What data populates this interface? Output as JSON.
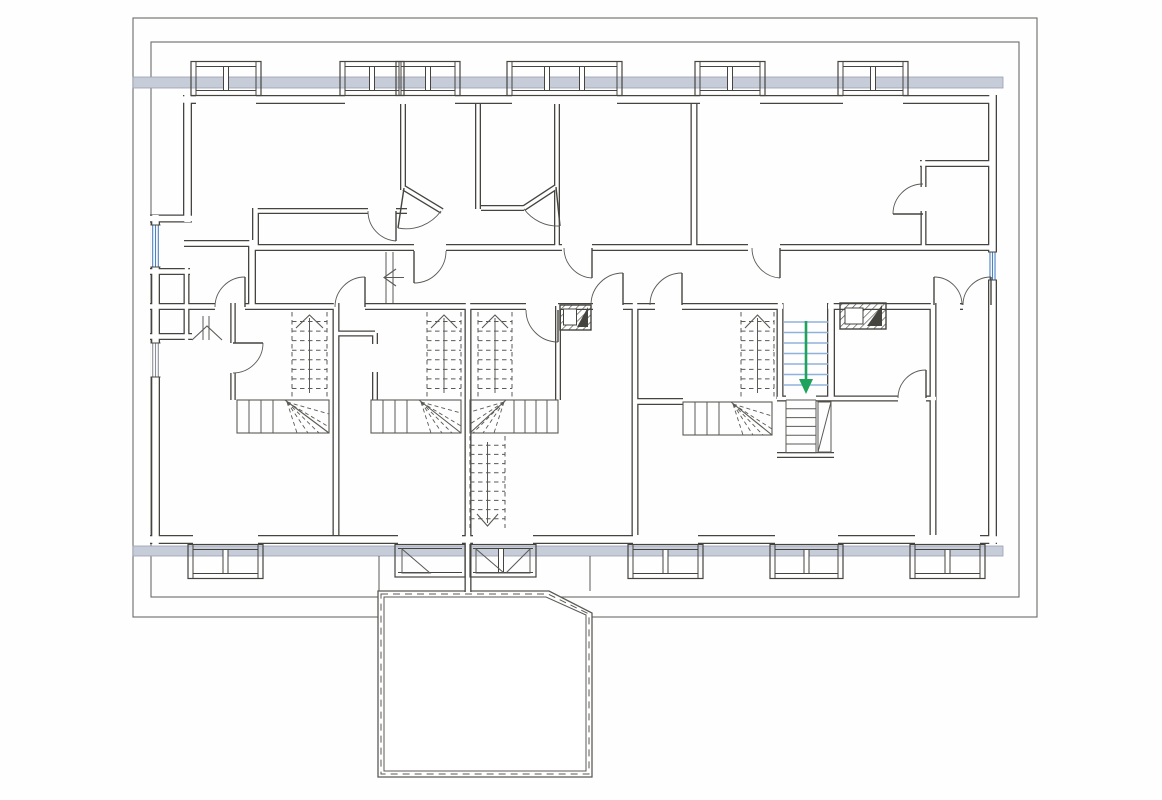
{
  "plan": {
    "canvas": {
      "w": 1162,
      "h": 800,
      "bg": "#fefefe"
    },
    "colors": {
      "ink": "#45443f",
      "thin": "#5b5a55",
      "eave": "#6b6b68",
      "white": "#ffffff",
      "band_fill": "#c6ccd8",
      "band_edge": "#99a1b3",
      "window_blue": "#4b80c2",
      "window_gray": "#8a8f99",
      "stair_blue": "#8fb2da",
      "arrow_green": "#1ea35c",
      "hatch": "#4a4a46"
    },
    "eaves": [
      {
        "x": 133,
        "y": 18,
        "w": 904,
        "h": 599
      },
      {
        "x": 151,
        "y": 42,
        "w": 868,
        "h": 555
      }
    ],
    "sill_bands": [
      {
        "x": 133,
        "y": 77,
        "w": 870,
        "h": 11
      },
      {
        "x": 133,
        "y": 546,
        "w": 870,
        "h": 10
      }
    ],
    "walls": [
      {
        "t": 9,
        "segs": [
          [
            183,
            99.5,
            196,
            99.5
          ],
          [
            256,
            99.5,
            345,
            99.5
          ],
          [
            455,
            99.5,
            512,
            99.5
          ],
          [
            617,
            99.5,
            700,
            99.5
          ],
          [
            760,
            99.5,
            843,
            99.5
          ],
          [
            903,
            99.5,
            992,
            99.5
          ],
          [
            150,
            539.5,
            193,
            539.5
          ],
          [
            258,
            539.5,
            398,
            539.5
          ],
          [
            462,
            539.5,
            473,
            539.5
          ],
          [
            533,
            539.5,
            633,
            539.5
          ],
          [
            698,
            539.5,
            775,
            539.5
          ],
          [
            838,
            539.5,
            915,
            539.5
          ],
          [
            980,
            539.5,
            997,
            539.5
          ],
          [
            187.5,
            95,
            187.5,
            222
          ],
          [
            155.5,
            215,
            155.5,
            544
          ],
          [
            992.5,
            95,
            992.5,
            544
          ]
        ]
      },
      {
        "t": 8,
        "segs": [
          [
            252,
            240,
            252,
            307
          ],
          [
            150,
            218.5,
            192,
            218.5
          ],
          [
            831,
            303,
            831,
            399
          ]
        ]
      },
      {
        "t": 7,
        "segs": [
          [
            252,
            247.5,
            414,
            247.5
          ],
          [
            446,
            247.5,
            562,
            247.5
          ],
          [
            592,
            247.5,
            748,
            247.5
          ],
          [
            780,
            247.5,
            992,
            247.5
          ],
          [
            184,
            243.5,
            256,
            243.5
          ],
          [
            255.5,
            208,
            255.5,
            247
          ],
          [
            150,
            306.5,
            215,
            306.5
          ],
          [
            245,
            306.5,
            335,
            306.5
          ],
          [
            365,
            306.5,
            526,
            306.5
          ],
          [
            558,
            306.5,
            593,
            306.5
          ],
          [
            623,
            306.5,
            655,
            306.5
          ],
          [
            682,
            306.5,
            783,
            306.5
          ],
          [
            828,
            306.5,
            934,
            306.5
          ],
          [
            960,
            306.5,
            963,
            306.5
          ],
          [
            150,
            271.5,
            190,
            271.5
          ],
          [
            150,
            336.5,
            192,
            336.5
          ],
          [
            694,
            104,
            694,
            247
          ],
          [
            920,
            163.5,
            992,
            163.5
          ],
          [
            336,
            303,
            336,
            535
          ],
          [
            468,
            303,
            468,
            592
          ],
          [
            635,
            303,
            635,
            535
          ],
          [
            633,
            401.5,
            683,
            401.5
          ],
          [
            780,
            303,
            780,
            399
          ],
          [
            933,
            303,
            933,
            535
          ]
        ]
      },
      {
        "t": 6,
        "segs": [
          [
            186.5,
            268,
            186.5,
            340
          ],
          [
            403,
            104,
            403,
            190
          ],
          [
            478,
            104,
            478,
            209
          ],
          [
            481,
            208,
            524,
            208
          ],
          [
            557,
            104,
            557,
            247
          ],
          [
            404,
            188,
            442,
            211
          ],
          [
            524,
            208,
            556,
            187
          ],
          [
            923.5,
            160,
            923.5,
            187
          ],
          [
            923.5,
            211,
            923.5,
            247
          ],
          [
            558,
            306,
            558,
            400
          ],
          [
            336,
            333.5,
            375,
            333.5
          ],
          [
            375,
            333,
            375,
            344
          ],
          [
            375,
            372,
            375,
            400
          ],
          [
            777,
            455,
            834,
            455
          ],
          [
            777,
            398.5,
            786,
            398.5
          ],
          [
            816,
            398.5,
            836,
            398.5
          ],
          [
            836,
            398.5,
            898,
            398.5
          ],
          [
            926,
            398.5,
            936,
            398.5
          ],
          [
            255,
            211,
            368,
            211
          ],
          [
            396,
            211,
            407,
            211
          ]
        ]
      },
      {
        "t": 5.5,
        "segs": [
          [
            233,
            303,
            233,
            343
          ],
          [
            233,
            373,
            233,
            400
          ]
        ]
      }
    ],
    "top_dormers": [
      [
        196,
        256,
        2
      ],
      [
        345,
        399,
        2
      ],
      [
        401,
        455,
        2
      ],
      [
        512,
        617,
        3
      ],
      [
        700,
        760,
        2
      ],
      [
        843,
        903,
        2
      ]
    ],
    "bottom_dormers": [
      [
        193,
        258,
        2
      ],
      [
        633,
        698,
        2
      ],
      [
        775,
        838,
        2
      ],
      [
        915,
        980,
        2
      ]
    ],
    "terrace": {
      "outer": [
        [
          378,
          591
        ],
        [
          549,
          591
        ],
        [
          592,
          613
        ],
        [
          592,
          777
        ],
        [
          378,
          777
        ]
      ],
      "inner": [
        [
          384,
          597
        ],
        [
          546,
          597
        ],
        [
          586,
          615
        ],
        [
          586,
          771
        ],
        [
          384,
          771
        ]
      ],
      "dash": [
        [
          381,
          594
        ],
        [
          548,
          594
        ],
        [
          589,
          614
        ],
        [
          589,
          774
        ],
        [
          381,
          774
        ]
      ],
      "connectors": [
        [
          379,
          556,
          379,
          591
        ],
        [
          590,
          556,
          590,
          591
        ]
      ],
      "bays": [
        {
          "x0": 398,
          "x1": 462,
          "posts": []
        },
        {
          "x0": 473,
          "x1": 533,
          "posts": [
            501
          ]
        }
      ],
      "door_triangles": [
        [
          [
            402,
            573
          ],
          [
            402,
            549
          ],
          [
            430,
            573
          ]
        ],
        [
          [
            476,
            573
          ],
          [
            476,
            549
          ],
          [
            504,
            573
          ]
        ],
        [
          [
            530,
            573
          ],
          [
            530,
            549
          ],
          [
            506,
            573
          ]
        ]
      ]
    },
    "side_windows": [
      {
        "rect": [
          150.5,
          225,
          10,
          42
        ],
        "color": "blue"
      },
      {
        "rect": [
          150.5,
          343,
          10,
          34
        ],
        "color": "gray"
      },
      {
        "rect": [
          988,
          252,
          9,
          28
        ],
        "color": "blue"
      }
    ],
    "doors": [
      {
        "leaf": [
          245,
          307,
          245,
          277
        ],
        "arc": "M215 307 A30 30 0 0 1 245 277"
      },
      {
        "leaf": [
          365,
          307,
          365,
          277
        ],
        "arc": "M335 307 A30 30 0 0 1 365 277"
      },
      {
        "leaf": [
          558,
          310,
          558,
          342
        ],
        "arc": "M526 310 A32 32 0 0 0 558 342"
      },
      {
        "leaf": [
          623,
          305,
          623,
          273
        ],
        "arc": "M591 305 A32 32 0 0 1 623 273"
      },
      {
        "leaf": [
          682,
          305,
          682,
          273
        ],
        "arc": "M650 305 A32 32 0 0 1 682 273"
      },
      {
        "leaf": [
          934,
          305,
          934,
          277
        ],
        "arc": "M962 305 A28 28 0 0 0 934 277"
      },
      {
        "leaf": [
          991,
          305,
          991,
          277
        ],
        "arc": "M963 305 A28 28 0 0 1 991 277"
      },
      {
        "leaf": [
          414,
          251,
          414,
          283
        ],
        "arc": "M414 283 A32 32 0 0 0 446 251"
      },
      {
        "leaf": [
          592,
          248,
          592,
          278
        ],
        "arc": "M564 248 A30 30 0 0 0 592 278"
      },
      {
        "leaf": [
          780,
          248,
          780,
          278
        ],
        "arc": "M752 248 A30 30 0 0 0 780 278"
      },
      {
        "leaf": [
          404,
          188,
          398,
          228
        ],
        "arc": "M441 211 A43 43 0 0 1 398 228"
      },
      {
        "leaf": [
          556,
          187,
          560,
          226
        ],
        "arc": "M524 209 A42 42 0 0 0 560 226"
      },
      {
        "leaf": [
          396,
          211,
          396,
          241
        ],
        "arc": "M368 211 A30 30 0 0 0 396 241"
      },
      {
        "leaf": [
          923,
          214,
          893,
          214
        ],
        "arc": "M893 214 A30 30 0 0 1 923 184"
      },
      {
        "leaf": [
          233,
          343,
          263,
          343
        ],
        "arc": "M263 343 A30 30 0 0 1 233 373"
      },
      {
        "leaf": [
          926,
          398,
          926,
          370
        ],
        "arc": "M898 398 A28 28 0 0 1 926 370"
      }
    ],
    "flights_dashed": [
      {
        "x": 292,
        "y": 312,
        "w": 35,
        "h": 86,
        "n": 8,
        "dir": "up"
      },
      {
        "x": 427,
        "y": 312,
        "w": 34,
        "h": 86,
        "n": 8,
        "dir": "up"
      },
      {
        "x": 478,
        "y": 312,
        "w": 34,
        "h": 86,
        "n": 8,
        "dir": "up"
      },
      {
        "x": 741,
        "y": 312,
        "w": 33,
        "h": 86,
        "n": 8,
        "dir": "up"
      },
      {
        "x": 470,
        "y": 436,
        "w": 35,
        "h": 92,
        "n": 9,
        "dir": "down"
      }
    ],
    "winders": [
      {
        "rect": [
          237,
          400,
          92,
          33
        ],
        "treads": [
          249,
          261,
          273
        ],
        "diag": [
          285,
          400,
          329,
          433
        ],
        "pivot": [
          287,
          402
        ],
        "rays": [
          [
            297,
            433
          ],
          [
            308,
            433
          ],
          [
            319,
            433
          ],
          [
            329,
            427
          ],
          [
            329,
            414
          ]
        ]
      },
      {
        "rect": [
          371,
          400,
          90,
          33
        ],
        "treads": [
          383,
          395,
          407
        ],
        "diag": [
          419,
          400,
          461,
          433
        ],
        "pivot": [
          421,
          402
        ],
        "rays": [
          [
            431,
            433
          ],
          [
            442,
            433
          ],
          [
            452,
            433
          ],
          [
            461,
            426
          ],
          [
            461,
            413
          ]
        ]
      },
      {
        "rect": [
          470,
          400,
          88,
          33
        ],
        "treads": [
          514,
          525,
          536,
          547
        ],
        "diag": [
          506,
          400,
          470,
          433
        ],
        "pivot": [
          504,
          402
        ],
        "rays": [
          [
            494,
            433
          ],
          [
            483,
            433
          ],
          [
            473,
            433
          ],
          [
            470,
            424
          ],
          [
            470,
            412
          ]
        ]
      },
      {
        "rect": [
          683,
          402,
          89,
          33
        ],
        "treads": [
          695,
          707,
          719
        ],
        "diag": [
          731,
          402,
          772,
          435
        ],
        "pivot": [
          733,
          404
        ],
        "rays": [
          [
            743,
            435
          ],
          [
            753,
            435
          ],
          [
            763,
            435
          ],
          [
            772,
            429
          ],
          [
            772,
            416
          ]
        ]
      }
    ],
    "main_stair_down": {
      "x": 784,
      "y": 318,
      "w": 44,
      "n": 7,
      "step": 10.5,
      "arrow_stem": [
        806,
        321,
        806,
        380
      ],
      "arrow_head": [
        [
          799,
          379
        ],
        [
          813,
          379
        ],
        [
          806,
          394
        ]
      ]
    },
    "small_stair": {
      "x": 786,
      "y": 400,
      "w": 30,
      "n": 6,
      "step": 8.8,
      "closet": [
        818,
        402,
        13,
        50
      ]
    },
    "chimneys": [
      {
        "rect": [
          560,
          305,
          31,
          25
        ],
        "white": [
          563.5,
          309,
          13,
          16
        ],
        "tri": [
          [
            577,
            327
          ],
          [
            588,
            307
          ],
          [
            588,
            327
          ]
        ]
      },
      {
        "rect": [
          840,
          303,
          46,
          26
        ],
        "white": [
          845,
          308,
          18,
          16
        ],
        "tri": [
          [
            867,
            326
          ],
          [
            882,
            305
          ],
          [
            882,
            326
          ]
        ]
      }
    ],
    "steps": {
      "lines": [
        [
          386,
          252,
          386,
          303
        ],
        [
          393,
          252,
          393,
          303
        ],
        [
          203,
          316,
          203,
          340
        ],
        [
          209,
          316,
          209,
          340
        ]
      ],
      "stems": [
        [
          384,
          277.5,
          404,
          277.5
        ]
      ],
      "chevrons": [
        [
          396,
          269,
          384,
          277.5,
          396,
          286
        ],
        [
          192,
          340,
          207,
          326,
          222,
          340
        ]
      ]
    }
  }
}
